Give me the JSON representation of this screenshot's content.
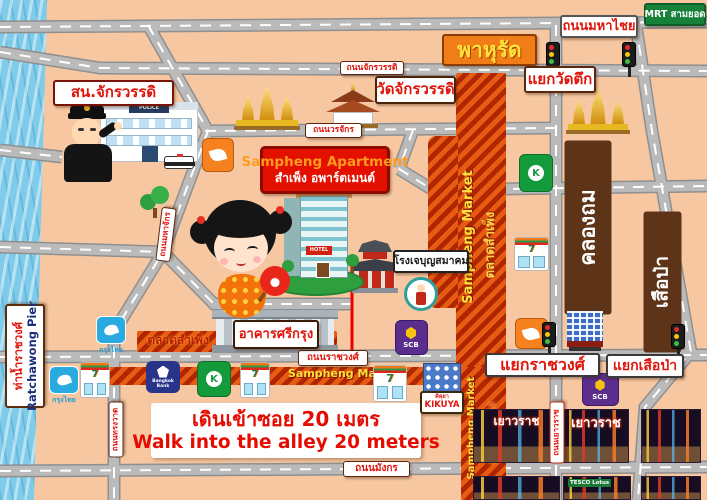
{
  "badges": {
    "mrt": "MRT สามยอด",
    "mahachai_rd": "ถนนมหาไชย",
    "phahurat": "พาหุรัด",
    "chakkrawat_rd": "ถนนจักรวรรดิ",
    "wat_tuek_int": "แยกวัดตึก",
    "wat_chakkrawat": "วัดจักรวรรดิ",
    "police_station": "สน.จักรวรรดิ",
    "worachak_rd": "ถนนวรจักร",
    "mahachak_rd": "ถนนมหาจักร",
    "rong_je": "โรงเจบุญสมาคม",
    "khlong_thom": "คลองถม",
    "suea_pa_area": "เสือป่า",
    "ratchawong_int": "แยกราชวงศ์",
    "suea_pa_int": "แยกเสือป่า",
    "ratchawong_rd": "ถนนราชวงศ์",
    "si_krung": "อาคารศรีกรุง",
    "song_wat_rd": "ถนนทรงวาด",
    "mangkon_rd": "ถนนมังกร",
    "yaowarat_rd": "ถนนเยาวราช",
    "pier_th": "ท่าน้ำราชวงศ์",
    "pier_en": "Ratchawong Pier",
    "kikuya_th": "คิคุยา",
    "kikuya_en": "KIKUYA"
  },
  "apartment": {
    "name_en": "Sampheng Apartment",
    "name_th": "สำเพ็ง อพาร์ตเมนต์",
    "hotel_sign": "HOTEL"
  },
  "market": {
    "en": "Sampheng Market",
    "th": "ตลาดสำเพ็ง"
  },
  "instruction": {
    "th": "เดินเข้าซอย 20 เมตร",
    "en": "Walk into the alley 20 meters"
  },
  "brands": {
    "scb": "SCB",
    "krungthai": "กรุงไทย",
    "bangkok_bank": "Bangkok Bank",
    "seven": "7",
    "police_sign": "POLICE"
  },
  "photos": {
    "yaowarat_sign": "เยาวราช",
    "tesco": "TESCO Lotus"
  },
  "colors": {
    "background": "#f6c7a0",
    "river": "#7fccea",
    "road": "#bababa",
    "label_red": "#e0140a",
    "market_red": "#c43000",
    "market_orange": "#e8601c",
    "area_brown": "#5d3418",
    "phahurat_orange": "#f07d18",
    "phahurat_yellow": "#ffe23c",
    "mrt_green": "#17813a",
    "apartment_red": "#e31000",
    "scb_purple": "#5b2e8e",
    "kbank_green": "#139b3b",
    "ktb_blue": "#29abe2",
    "bbl_navy": "#28348a",
    "thanachart_orange": "#f5821f",
    "route_red": "#ee0000"
  }
}
